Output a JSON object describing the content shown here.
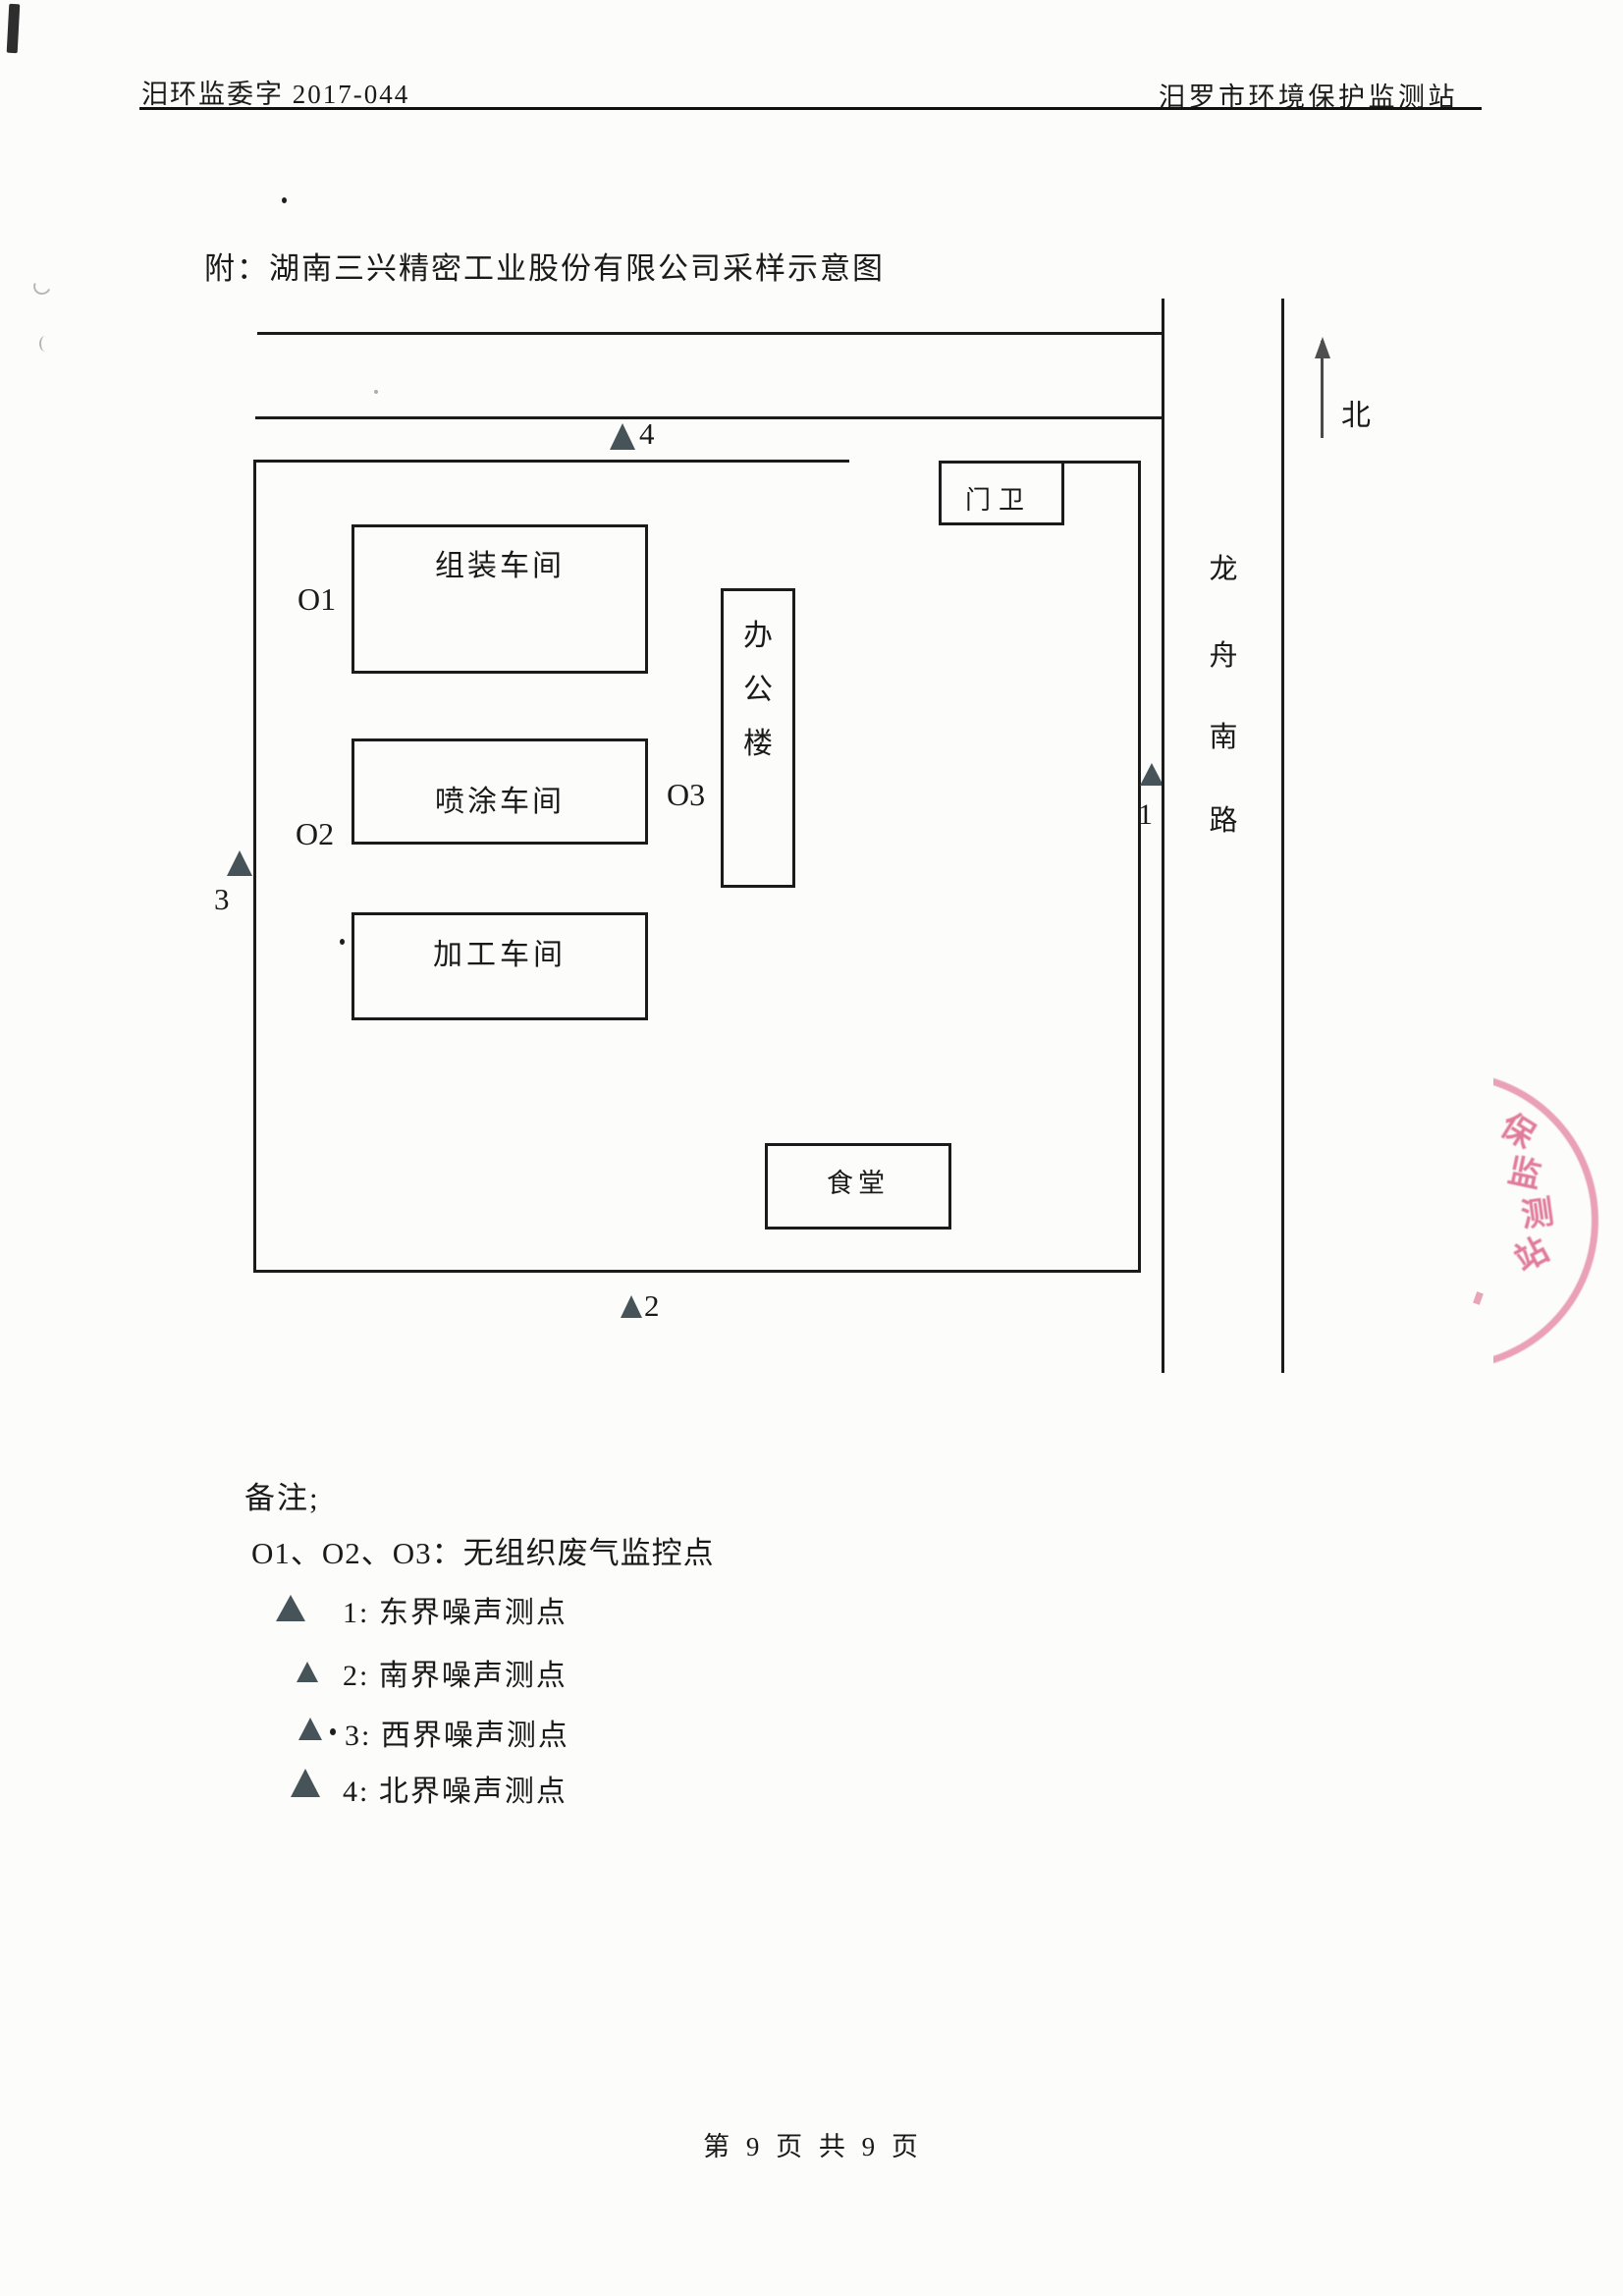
{
  "header": {
    "left": "汨环监委字 2017-044",
    "right": "汨罗市环境保护监测站"
  },
  "title": "附：湖南三兴精密工业股份有限公司采样示意图",
  "diagram": {
    "north_label": "北",
    "road_chars": [
      "龙",
      "舟",
      "南",
      "路"
    ],
    "guard_label": "门卫",
    "assembly_label": "组装车间",
    "office_chars": [
      "办",
      "公",
      "楼"
    ],
    "paint_label": "喷涂车间",
    "processing_label": "加工车间",
    "canteen_label": "食堂",
    "gas_points": {
      "o1": "O1",
      "o2": "O2",
      "o3": "O3"
    },
    "noise_points": {
      "n1": "1",
      "n2": "2",
      "n3": "3",
      "n4": "4"
    }
  },
  "notes": {
    "heading": "备注;",
    "gas_line": "O1、O2、O3：无组织废气监控点",
    "items": [
      {
        "num": "1:",
        "label": "东界噪声测点"
      },
      {
        "num": "2:",
        "label": "南界噪声测点"
      },
      {
        "num": "3:",
        "label": "西界噪声测点"
      },
      {
        "num": "4:",
        "label": "北界噪声测点"
      }
    ]
  },
  "footer": "第 9 页 共 9 页",
  "stamp": {
    "chars": [
      "保",
      "监",
      "测",
      "站"
    ],
    "color": "#d4446e"
  },
  "colors": {
    "ink": "#1a1a1a",
    "line": "#1b1b1b",
    "triangle": "#46545a",
    "stamp_pink": "#d4446e"
  }
}
